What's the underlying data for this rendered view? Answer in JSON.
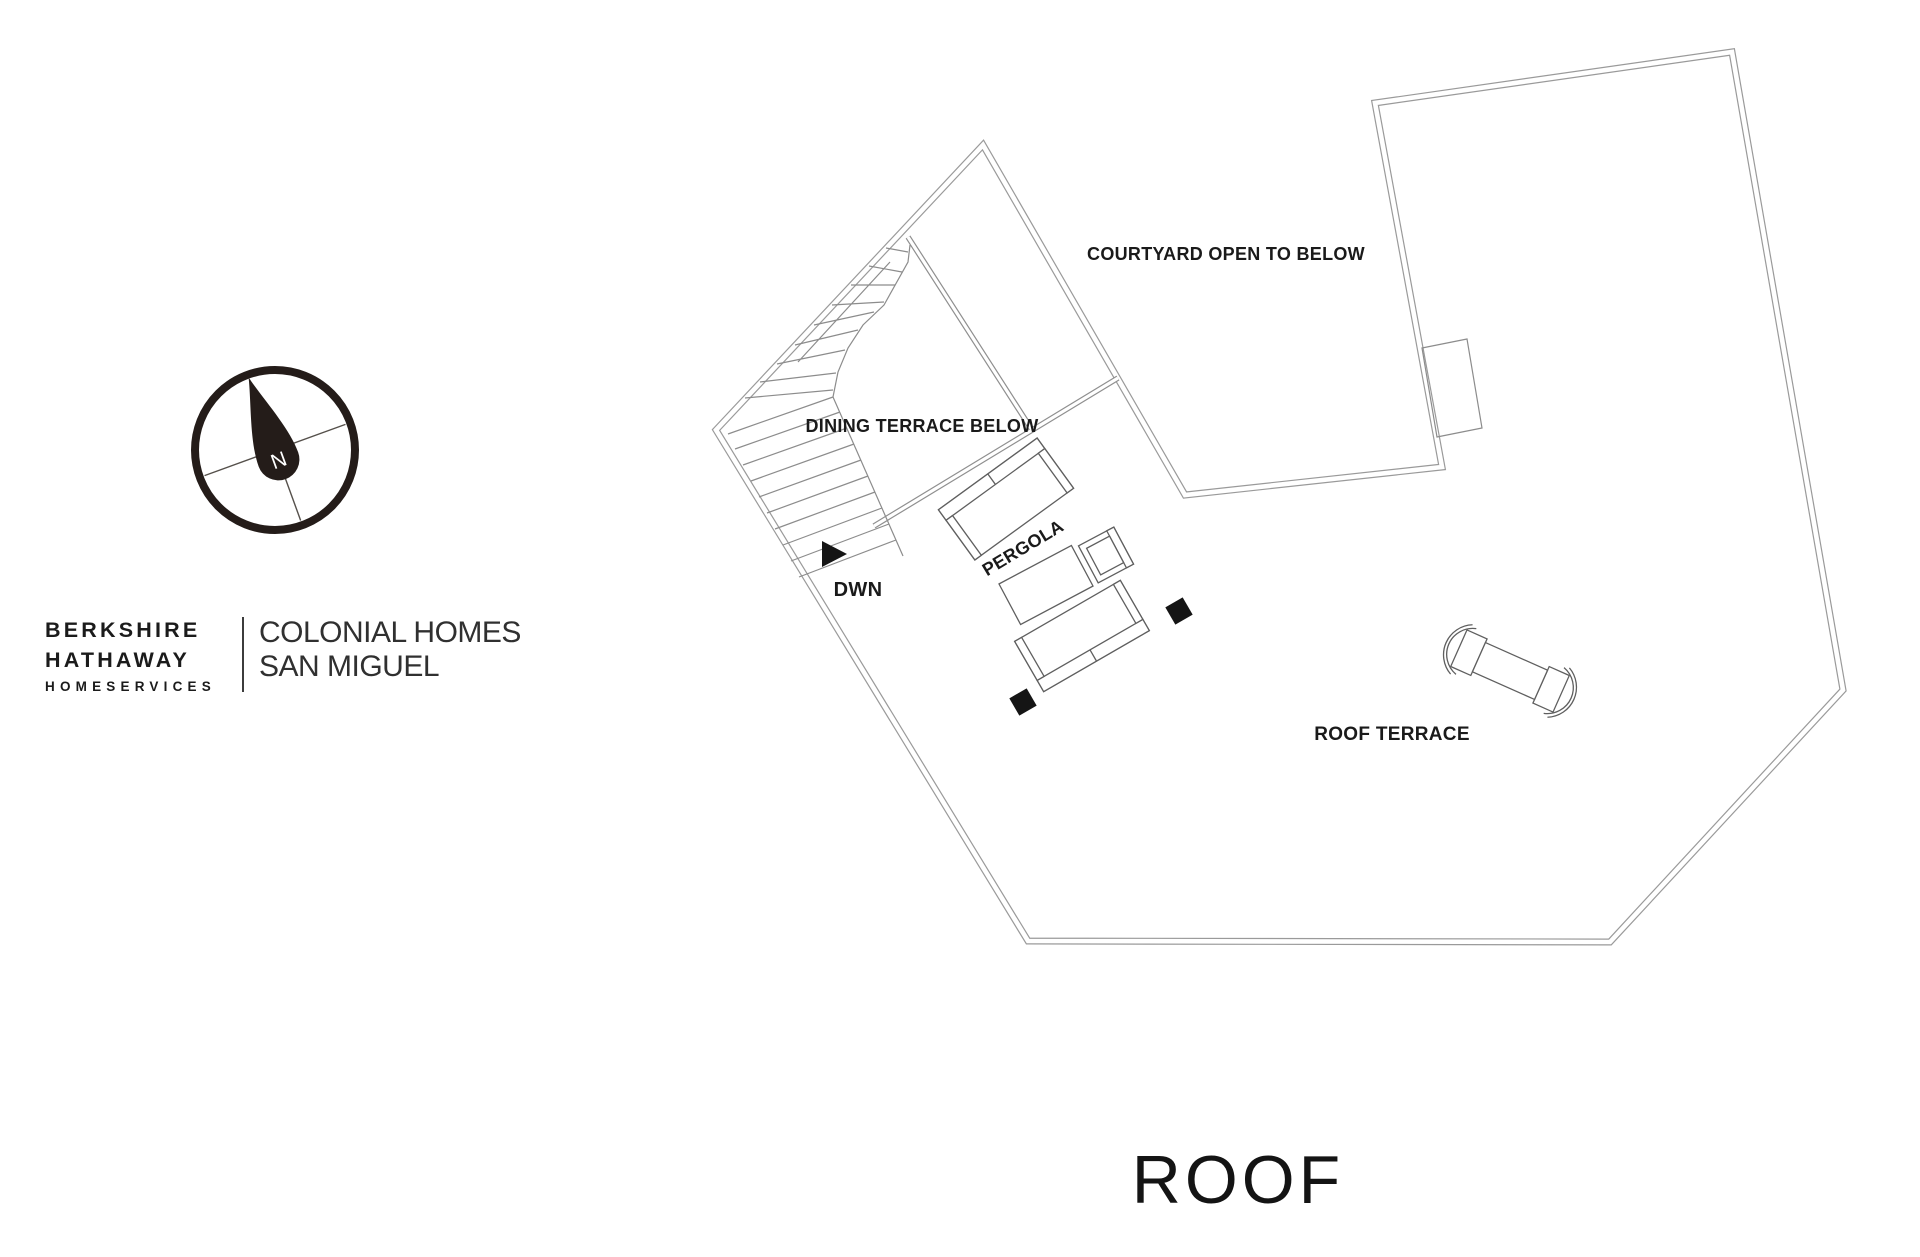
{
  "branding": {
    "line1": "BERKSHIRE",
    "line2": "HATHAWAY",
    "line3": "HOMESERVICES",
    "right_line1": "COLONIAL HOMES",
    "right_line2": "SAN MIGUEL"
  },
  "compass": {
    "label": "N"
  },
  "plan": {
    "labels": {
      "courtyard": "COURTYARD OPEN TO BELOW",
      "dining": "DINING TERRACE BELOW",
      "pergola": "PERGOLA",
      "dwn": "DWN",
      "roof_terrace": "ROOF TERRACE"
    }
  },
  "title": "ROOF",
  "colors": {
    "wall": "#9a9a9a",
    "furniture_outline": "#5f5f5f",
    "label_text": "#1a1a1a",
    "accent_black": "#151515",
    "compass_dark": "#241c19"
  }
}
